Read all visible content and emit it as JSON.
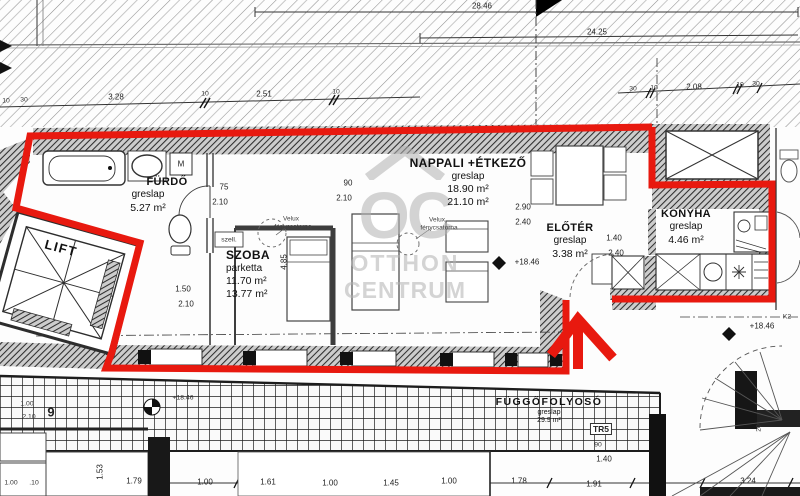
{
  "watermark": {
    "logo": "OC",
    "line1": "OTTHON",
    "line2": "CENTRUM"
  },
  "colors": {
    "outline": "#e8190f",
    "wall": "#2e2e2e",
    "line": "#444444",
    "watermark": "#b2b2b2"
  },
  "rooms": {
    "furdo": {
      "name": "FÜRDŐ",
      "finish": "greslap",
      "area": "5.27 m²"
    },
    "szoba": {
      "name": "SZOBA",
      "finish": "parketta",
      "area1": "11.70 m²",
      "area2": "13.77 m²"
    },
    "nappali": {
      "name": "NAPPALI +ÉTKEZŐ",
      "finish": "greslap",
      "area1": "18.90 m²",
      "area2": "21.10 m²"
    },
    "eloter": {
      "name": "ELŐTÉR",
      "finish": "greslap",
      "area": "3.38 m²"
    },
    "konyha": {
      "name": "KONYHA",
      "finish": "greslap",
      "area": "4.46 m²"
    },
    "lift": {
      "name": "LIFT"
    },
    "folyoso": {
      "name": "FÜGGŐFOLYOSÓ",
      "finish": "greslap",
      "area": "29.9 m²"
    }
  },
  "dims": [
    {
      "t": "28.46",
      "x": 482,
      "y": 6
    },
    {
      "t": "24.25",
      "x": 597,
      "y": 32
    },
    {
      "t": "10",
      "x": 6,
      "y": 101,
      "c": "t7"
    },
    {
      "t": "30",
      "x": 24,
      "y": 100,
      "c": "t7"
    },
    {
      "t": "3.28",
      "x": 116,
      "y": 97
    },
    {
      "t": "10",
      "x": 205,
      "y": 94,
      "c": "t7"
    },
    {
      "t": "2.51",
      "x": 264,
      "y": 94
    },
    {
      "t": "10",
      "x": 336,
      "y": 92,
      "c": "t7"
    },
    {
      "t": "30",
      "x": 633,
      "y": 89,
      "c": "t7"
    },
    {
      "t": "10",
      "x": 654,
      "y": 88,
      "c": "t7"
    },
    {
      "t": "2.08",
      "x": 694,
      "y": 87
    },
    {
      "t": "10",
      "x": 740,
      "y": 85,
      "c": "t7"
    },
    {
      "t": "30",
      "x": 756,
      "y": 84,
      "c": "t7"
    },
    {
      "t": "75",
      "x": 224,
      "y": 187
    },
    {
      "t": "2.10",
      "x": 220,
      "y": 202
    },
    {
      "t": "90",
      "x": 348,
      "y": 183
    },
    {
      "t": "2.10",
      "x": 344,
      "y": 198
    },
    {
      "t": "1.50",
      "x": 183,
      "y": 289
    },
    {
      "t": "2.10",
      "x": 186,
      "y": 304
    },
    {
      "t": "4.85",
      "x": 284,
      "y": 262,
      "c": "rot"
    },
    {
      "t": "2.90",
      "x": 523,
      "y": 207
    },
    {
      "t": "2.40",
      "x": 523,
      "y": 222
    },
    {
      "t": "1.40",
      "x": 614,
      "y": 238
    },
    {
      "t": "2.40",
      "x": 616,
      "y": 253
    },
    {
      "t": "+18.46",
      "x": 527,
      "y": 262,
      "n": "elevation-label"
    },
    {
      "t": "+18.46",
      "x": 762,
      "y": 326,
      "n": "elevation-label"
    },
    {
      "t": "+18.46",
      "x": 183,
      "y": 398,
      "c": "t7",
      "n": "elevation-label"
    },
    {
      "t": "K2",
      "x": 787,
      "y": 317,
      "c": "t7"
    },
    {
      "t": "M",
      "x": 181,
      "y": 164,
      "n": "washing-machine-label"
    },
    {
      "t": "szell.",
      "x": 229,
      "y": 240,
      "c": "t7"
    },
    {
      "t": "Velux",
      "x": 291,
      "y": 219,
      "c": "tiny"
    },
    {
      "t": "fénycsatorna",
      "x": 293,
      "y": 227,
      "c": "tiny"
    },
    {
      "t": "Velux",
      "x": 437,
      "y": 220,
      "c": "tiny"
    },
    {
      "t": "fénycsatorna",
      "x": 439,
      "y": 228,
      "c": "tiny"
    },
    {
      "t": "9",
      "x": 51,
      "y": 412,
      "c": "big",
      "n": "grid-line-label"
    },
    {
      "t": "1.00",
      "x": 27,
      "y": 404,
      "c": "t7"
    },
    {
      "t": "2.10",
      "x": 29,
      "y": 417,
      "c": "t7"
    },
    {
      "t": "TR5",
      "x": 601,
      "y": 429,
      "c": "boxed",
      "n": "tr5-label"
    },
    {
      "t": "90",
      "x": 598,
      "y": 445,
      "c": "t7"
    },
    {
      "t": "1.40",
      "x": 604,
      "y": 459
    },
    {
      "t": "20",
      "x": 759,
      "y": 428,
      "c": "t7 rot"
    },
    {
      "t": "1.53",
      "x": 100,
      "y": 472,
      "c": "rot"
    },
    {
      "t": "1.79",
      "x": 134,
      "y": 481
    },
    {
      "t": "1.00",
      "x": 205,
      "y": 482
    },
    {
      "t": "1.61",
      "x": 268,
      "y": 482
    },
    {
      "t": "1.00",
      "x": 330,
      "y": 483
    },
    {
      "t": "1.45",
      "x": 391,
      "y": 483
    },
    {
      "t": "1.00",
      "x": 449,
      "y": 481
    },
    {
      "t": "1.78",
      "x": 519,
      "y": 481
    },
    {
      "t": "1.91",
      "x": 594,
      "y": 484
    },
    {
      "t": "3.24",
      "x": 748,
      "y": 481
    },
    {
      "t": "1.00",
      "x": 11,
      "y": 483,
      "c": "t7"
    },
    {
      "t": ".10",
      "x": 34,
      "y": 483,
      "c": "t7"
    }
  ]
}
